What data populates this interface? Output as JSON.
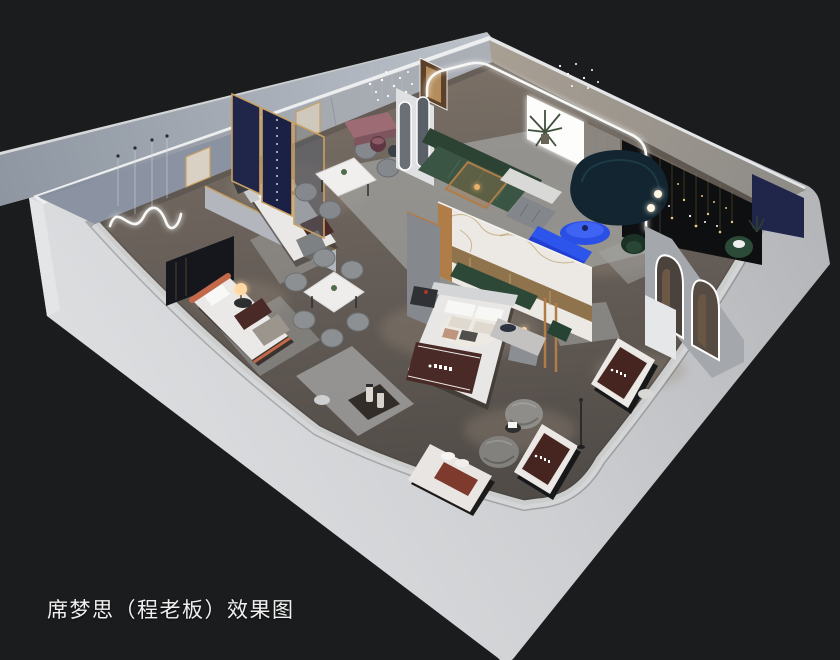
{
  "caption": {
    "text": "席梦思（程老板）效果图"
  },
  "palette": {
    "background": "#1b1c1e",
    "outer_wall_light": "#dfe0e2",
    "outer_wall_mid": "#b4b6b9",
    "floor_wood": "#6a625b",
    "rug_gray": "#a2a3a1",
    "accent_blue": "#2a4fe4",
    "accent_blue_dark": "#2140d2",
    "sofa_green": "#3a5544",
    "sofa_green_dark": "#2c4334",
    "sofa_teal_dark": "#122530",
    "bench_mauve": "#9c6b74",
    "panel_navy": "#1f264a",
    "mattress_brown": "#46241f",
    "runner_brown": "#4a2a26",
    "frame_gold": "#c9a063",
    "wood_gold": "#b07c48",
    "bed_orange": "#c4684a",
    "led_white": "#f8f8f6",
    "lamp_warm": "#ffd9a0",
    "marble_white": "#ece9e4",
    "feature_wall_dark": "#0e0f11"
  }
}
